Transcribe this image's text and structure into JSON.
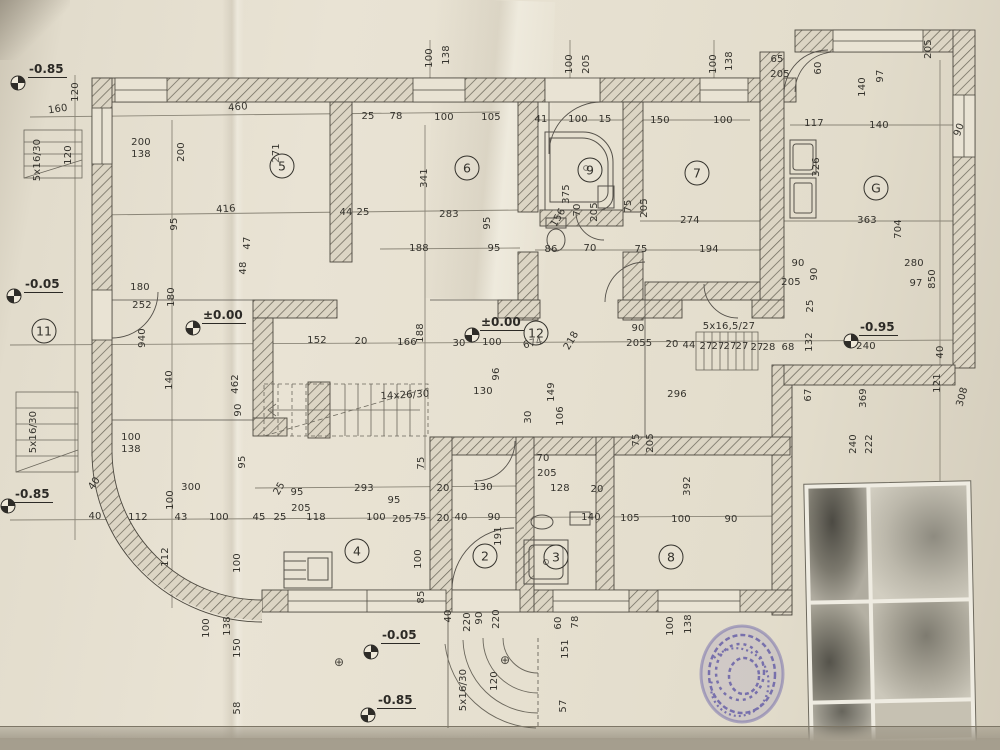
{
  "watermark": {
    "line1": "Moj Kvadrat",
    "line2": "011/334-88-36",
    "color": "#ecdf2e"
  },
  "plan": {
    "rooms": [
      {
        "id": "5",
        "x": 282,
        "y": 166
      },
      {
        "id": "6",
        "x": 467,
        "y": 168
      },
      {
        "id": "9",
        "x": 590,
        "y": 170
      },
      {
        "id": "7",
        "x": 697,
        "y": 173
      },
      {
        "id": "G",
        "x": 876,
        "y": 188
      },
      {
        "id": "11",
        "x": 44,
        "y": 331
      },
      {
        "id": "12",
        "x": 536,
        "y": 333
      },
      {
        "id": "4",
        "x": 357,
        "y": 551
      },
      {
        "id": "2",
        "x": 485,
        "y": 556
      },
      {
        "id": "3",
        "x": 556,
        "y": 557
      },
      {
        "id": "8",
        "x": 671,
        "y": 557
      }
    ],
    "elevations": [
      {
        "value": "-0.85",
        "cx": 18,
        "cy": 85,
        "tx": 28,
        "ty": 62
      },
      {
        "value": "-0.05",
        "cx": 14,
        "cy": 298,
        "tx": 24,
        "ty": 277
      },
      {
        "value": "±0.00",
        "cx": 193,
        "cy": 330,
        "tx": 202,
        "ty": 308
      },
      {
        "value": "±0.00",
        "cx": 472,
        "cy": 337,
        "tx": 480,
        "ty": 315
      },
      {
        "value": "-0.95",
        "cx": 851,
        "cy": 343,
        "tx": 859,
        "ty": 320
      },
      {
        "value": "-0.85",
        "cx": 8,
        "cy": 508,
        "tx": 14,
        "ty": 487
      },
      {
        "value": "-0.05",
        "cx": 371,
        "cy": 654,
        "tx": 381,
        "ty": 628
      },
      {
        "value": "-0.85",
        "cx": 368,
        "cy": 717,
        "tx": 377,
        "ty": 693
      }
    ],
    "symbols": [
      {
        "glyph": "⊕",
        "x": 339,
        "y": 662
      },
      {
        "glyph": "⊕",
        "x": 505,
        "y": 660
      }
    ],
    "labels": [
      {
        "t": "120",
        "x": 76,
        "y": 92,
        "r": -90
      },
      {
        "t": "160",
        "x": 58,
        "y": 110,
        "r": -8
      },
      {
        "t": "460",
        "x": 238,
        "y": 108,
        "r": -5
      },
      {
        "t": "200",
        "x": 141,
        "y": 143
      },
      {
        "t": "138",
        "x": 141,
        "y": 155
      },
      {
        "t": "200",
        "x": 182,
        "y": 152,
        "r": -90
      },
      {
        "t": "5x16/30",
        "x": 38,
        "y": 160,
        "r": -90
      },
      {
        "t": "120",
        "x": 69,
        "y": 155,
        "r": -90
      },
      {
        "t": "416",
        "x": 226,
        "y": 210,
        "r": -4
      },
      {
        "t": "95",
        "x": 175,
        "y": 224,
        "r": -90
      },
      {
        "t": "271",
        "x": 277,
        "y": 153,
        "r": -90
      },
      {
        "t": "47",
        "x": 248,
        "y": 243,
        "r": -90
      },
      {
        "t": "48",
        "x": 244,
        "y": 268,
        "r": -90
      },
      {
        "t": "44",
        "x": 346,
        "y": 213
      },
      {
        "t": "25",
        "x": 363,
        "y": 213
      },
      {
        "t": "180",
        "x": 140,
        "y": 288
      },
      {
        "t": "252",
        "x": 142,
        "y": 306
      },
      {
        "t": "940",
        "x": 143,
        "y": 338,
        "r": -90
      },
      {
        "t": "180",
        "x": 172,
        "y": 297,
        "r": -90
      },
      {
        "t": "140",
        "x": 170,
        "y": 380,
        "r": -90
      },
      {
        "t": "462",
        "x": 236,
        "y": 384,
        "r": -90
      },
      {
        "t": "90",
        "x": 239,
        "y": 410,
        "r": -90
      },
      {
        "t": "100",
        "x": 131,
        "y": 438
      },
      {
        "t": "138",
        "x": 131,
        "y": 450
      },
      {
        "t": "40",
        "x": 95,
        "y": 484,
        "r": -55
      },
      {
        "t": "40",
        "x": 95,
        "y": 517
      },
      {
        "t": "112",
        "x": 138,
        "y": 518
      },
      {
        "t": "43",
        "x": 181,
        "y": 518
      },
      {
        "t": "100",
        "x": 219,
        "y": 518
      },
      {
        "t": "300",
        "x": 191,
        "y": 488
      },
      {
        "t": "100",
        "x": 171,
        "y": 500,
        "r": -90
      },
      {
        "t": "45",
        "x": 259,
        "y": 518
      },
      {
        "t": "25",
        "x": 280,
        "y": 518
      },
      {
        "t": "112",
        "x": 166,
        "y": 557,
        "r": -90
      },
      {
        "t": "100",
        "x": 238,
        "y": 563,
        "r": -90
      },
      {
        "t": "95",
        "x": 243,
        "y": 462,
        "r": -90
      },
      {
        "t": "100",
        "x": 207,
        "y": 628,
        "r": -90
      },
      {
        "t": "138",
        "x": 228,
        "y": 626,
        "r": -90
      },
      {
        "t": "150",
        "x": 238,
        "y": 648,
        "r": -90
      },
      {
        "t": "58",
        "x": 238,
        "y": 708,
        "r": -90
      },
      {
        "t": "5x16/30",
        "x": 34,
        "y": 432,
        "r": -90
      },
      {
        "t": "25",
        "x": 368,
        "y": 117
      },
      {
        "t": "78",
        "x": 396,
        "y": 117
      },
      {
        "t": "100",
        "x": 444,
        "y": 118
      },
      {
        "t": "105",
        "x": 491,
        "y": 118
      },
      {
        "t": "341",
        "x": 425,
        "y": 178,
        "r": -90
      },
      {
        "t": "283",
        "x": 449,
        "y": 215
      },
      {
        "t": "95",
        "x": 488,
        "y": 223,
        "r": -90
      },
      {
        "t": "188",
        "x": 419,
        "y": 249
      },
      {
        "t": "95",
        "x": 494,
        "y": 249
      },
      {
        "t": "100",
        "x": 430,
        "y": 58,
        "r": -90
      },
      {
        "t": "138",
        "x": 447,
        "y": 55,
        "r": -90
      },
      {
        "t": "100",
        "x": 570,
        "y": 64,
        "r": -90
      },
      {
        "t": "205",
        "x": 587,
        "y": 64,
        "r": -90
      },
      {
        "t": "41",
        "x": 541,
        "y": 120
      },
      {
        "t": "100",
        "x": 578,
        "y": 120
      },
      {
        "t": "15",
        "x": 605,
        "y": 120
      },
      {
        "t": "375",
        "x": 567,
        "y": 194,
        "r": -90
      },
      {
        "t": "156",
        "x": 559,
        "y": 218,
        "r": -60
      },
      {
        "t": "70",
        "x": 578,
        "y": 210,
        "r": -90
      },
      {
        "t": "205",
        "x": 595,
        "y": 212,
        "r": -90
      },
      {
        "t": "86",
        "x": 551,
        "y": 250
      },
      {
        "t": "70",
        "x": 590,
        "y": 249
      },
      {
        "t": "75",
        "x": 641,
        "y": 250
      },
      {
        "t": "75",
        "x": 629,
        "y": 206,
        "r": -90
      },
      {
        "t": "205",
        "x": 645,
        "y": 208,
        "r": -90
      },
      {
        "t": "150",
        "x": 660,
        "y": 121
      },
      {
        "t": "100",
        "x": 723,
        "y": 121
      },
      {
        "t": "100",
        "x": 714,
        "y": 64,
        "r": -90
      },
      {
        "t": "138",
        "x": 730,
        "y": 61,
        "r": -90
      },
      {
        "t": "274",
        "x": 690,
        "y": 221
      },
      {
        "t": "194",
        "x": 709,
        "y": 250
      },
      {
        "t": "65",
        "x": 777,
        "y": 60
      },
      {
        "t": "205",
        "x": 780,
        "y": 75
      },
      {
        "t": "60",
        "x": 819,
        "y": 68,
        "r": -90
      },
      {
        "t": "140",
        "x": 863,
        "y": 87,
        "r": -90
      },
      {
        "t": "97",
        "x": 881,
        "y": 76,
        "r": -90
      },
      {
        "t": "117",
        "x": 814,
        "y": 124
      },
      {
        "t": "140",
        "x": 879,
        "y": 126
      },
      {
        "t": "90",
        "x": 960,
        "y": 130,
        "r": -70
      },
      {
        "t": "326",
        "x": 817,
        "y": 167,
        "r": -90
      },
      {
        "t": "363",
        "x": 867,
        "y": 221
      },
      {
        "t": "704",
        "x": 899,
        "y": 229,
        "r": -90
      },
      {
        "t": "205",
        "x": 929,
        "y": 49,
        "r": -90
      },
      {
        "t": "90",
        "x": 798,
        "y": 264
      },
      {
        "t": "205",
        "x": 791,
        "y": 283
      },
      {
        "t": "90",
        "x": 815,
        "y": 274,
        "r": -90
      },
      {
        "t": "25",
        "x": 811,
        "y": 306,
        "r": -90
      },
      {
        "t": "280",
        "x": 914,
        "y": 264
      },
      {
        "t": "97",
        "x": 916,
        "y": 284
      },
      {
        "t": "850",
        "x": 933,
        "y": 279,
        "r": -90
      },
      {
        "t": "132",
        "x": 810,
        "y": 342,
        "r": -90
      },
      {
        "t": "68",
        "x": 788,
        "y": 348
      },
      {
        "t": "27",
        "x": 757,
        "y": 348
      },
      {
        "t": "28",
        "x": 769,
        "y": 348
      },
      {
        "t": "240",
        "x": 866,
        "y": 347
      },
      {
        "t": "121",
        "x": 938,
        "y": 383,
        "r": -90
      },
      {
        "t": "40",
        "x": 941,
        "y": 352,
        "r": -90
      },
      {
        "t": "67",
        "x": 809,
        "y": 395,
        "r": -90
      },
      {
        "t": "369",
        "x": 864,
        "y": 398,
        "r": -90
      },
      {
        "t": "240",
        "x": 854,
        "y": 444,
        "r": -90
      },
      {
        "t": "222",
        "x": 870,
        "y": 444,
        "r": -90
      },
      {
        "t": "308",
        "x": 963,
        "y": 397,
        "r": -75
      },
      {
        "t": "152",
        "x": 317,
        "y": 341
      },
      {
        "t": "20",
        "x": 361,
        "y": 342
      },
      {
        "t": "166",
        "x": 407,
        "y": 343
      },
      {
        "t": "188",
        "x": 421,
        "y": 333,
        "r": -90
      },
      {
        "t": "30",
        "x": 459,
        "y": 344
      },
      {
        "t": "100",
        "x": 492,
        "y": 343
      },
      {
        "t": "130",
        "x": 483,
        "y": 392
      },
      {
        "t": "96",
        "x": 497,
        "y": 374,
        "r": -90
      },
      {
        "t": "14x26/30",
        "x": 405,
        "y": 396,
        "r": -3
      },
      {
        "t": "674",
        "x": 533,
        "y": 344,
        "r": -15
      },
      {
        "t": "218",
        "x": 572,
        "y": 341,
        "r": -60
      },
      {
        "t": "90",
        "x": 638,
        "y": 329
      },
      {
        "t": "205",
        "x": 636,
        "y": 344
      },
      {
        "t": "5",
        "x": 649,
        "y": 344
      },
      {
        "t": "20",
        "x": 672,
        "y": 345
      },
      {
        "t": "44",
        "x": 689,
        "y": 346
      },
      {
        "t": "27",
        "x": 706,
        "y": 347
      },
      {
        "t": "27",
        "x": 718,
        "y": 347
      },
      {
        "t": "27",
        "x": 730,
        "y": 347
      },
      {
        "t": "27",
        "x": 742,
        "y": 347
      },
      {
        "t": "5x16,5/27",
        "x": 729,
        "y": 327
      },
      {
        "t": "296",
        "x": 677,
        "y": 395
      },
      {
        "t": "149",
        "x": 552,
        "y": 392,
        "r": -90
      },
      {
        "t": "106",
        "x": 561,
        "y": 416,
        "r": -90
      },
      {
        "t": "30",
        "x": 529,
        "y": 417,
        "r": -90
      },
      {
        "t": "75",
        "x": 637,
        "y": 440,
        "r": -90
      },
      {
        "t": "205",
        "x": 651,
        "y": 443,
        "r": -90
      },
      {
        "t": "95",
        "x": 297,
        "y": 493
      },
      {
        "t": "205",
        "x": 301,
        "y": 509
      },
      {
        "t": "293",
        "x": 364,
        "y": 489
      },
      {
        "t": "95",
        "x": 394,
        "y": 501
      },
      {
        "t": "118",
        "x": 316,
        "y": 518
      },
      {
        "t": "100",
        "x": 376,
        "y": 518
      },
      {
        "t": "205",
        "x": 402,
        "y": 520
      },
      {
        "t": "75",
        "x": 420,
        "y": 518
      },
      {
        "t": "20",
        "x": 443,
        "y": 519
      },
      {
        "t": "40",
        "x": 461,
        "y": 518
      },
      {
        "t": "90",
        "x": 494,
        "y": 518
      },
      {
        "t": "25",
        "x": 280,
        "y": 489,
        "r": -60
      },
      {
        "t": "20",
        "x": 443,
        "y": 489
      },
      {
        "t": "130",
        "x": 483,
        "y": 488
      },
      {
        "t": "75",
        "x": 422,
        "y": 463,
        "r": -90
      },
      {
        "t": "191",
        "x": 499,
        "y": 536,
        "r": -90
      },
      {
        "t": "100",
        "x": 419,
        "y": 559,
        "r": -90
      },
      {
        "t": "85",
        "x": 422,
        "y": 597,
        "r": -90
      },
      {
        "t": "70",
        "x": 543,
        "y": 459
      },
      {
        "t": "205",
        "x": 547,
        "y": 474
      },
      {
        "t": "128",
        "x": 560,
        "y": 489
      },
      {
        "t": "20",
        "x": 597,
        "y": 490
      },
      {
        "t": "140",
        "x": 591,
        "y": 518
      },
      {
        "t": "105",
        "x": 630,
        "y": 519
      },
      {
        "t": "100",
        "x": 681,
        "y": 520
      },
      {
        "t": "90",
        "x": 731,
        "y": 520
      },
      {
        "t": "392",
        "x": 688,
        "y": 486,
        "r": -90
      },
      {
        "t": "60",
        "x": 559,
        "y": 623,
        "r": -90
      },
      {
        "t": "78",
        "x": 576,
        "y": 622,
        "r": -90
      },
      {
        "t": "100",
        "x": 671,
        "y": 626,
        "r": -90
      },
      {
        "t": "138",
        "x": 689,
        "y": 624,
        "r": -90
      },
      {
        "t": "40",
        "x": 449,
        "y": 616,
        "r": -90
      },
      {
        "t": "220",
        "x": 468,
        "y": 622,
        "r": -90
      },
      {
        "t": "90",
        "x": 480,
        "y": 618,
        "r": -90
      },
      {
        "t": "220",
        "x": 497,
        "y": 619,
        "r": -90
      },
      {
        "t": "120",
        "x": 495,
        "y": 681,
        "r": -90
      },
      {
        "t": "5x16/30",
        "x": 464,
        "y": 690,
        "r": -90
      },
      {
        "t": "151",
        "x": 566,
        "y": 649,
        "r": -90
      },
      {
        "t": "57",
        "x": 564,
        "y": 706,
        "r": -90
      }
    ]
  }
}
